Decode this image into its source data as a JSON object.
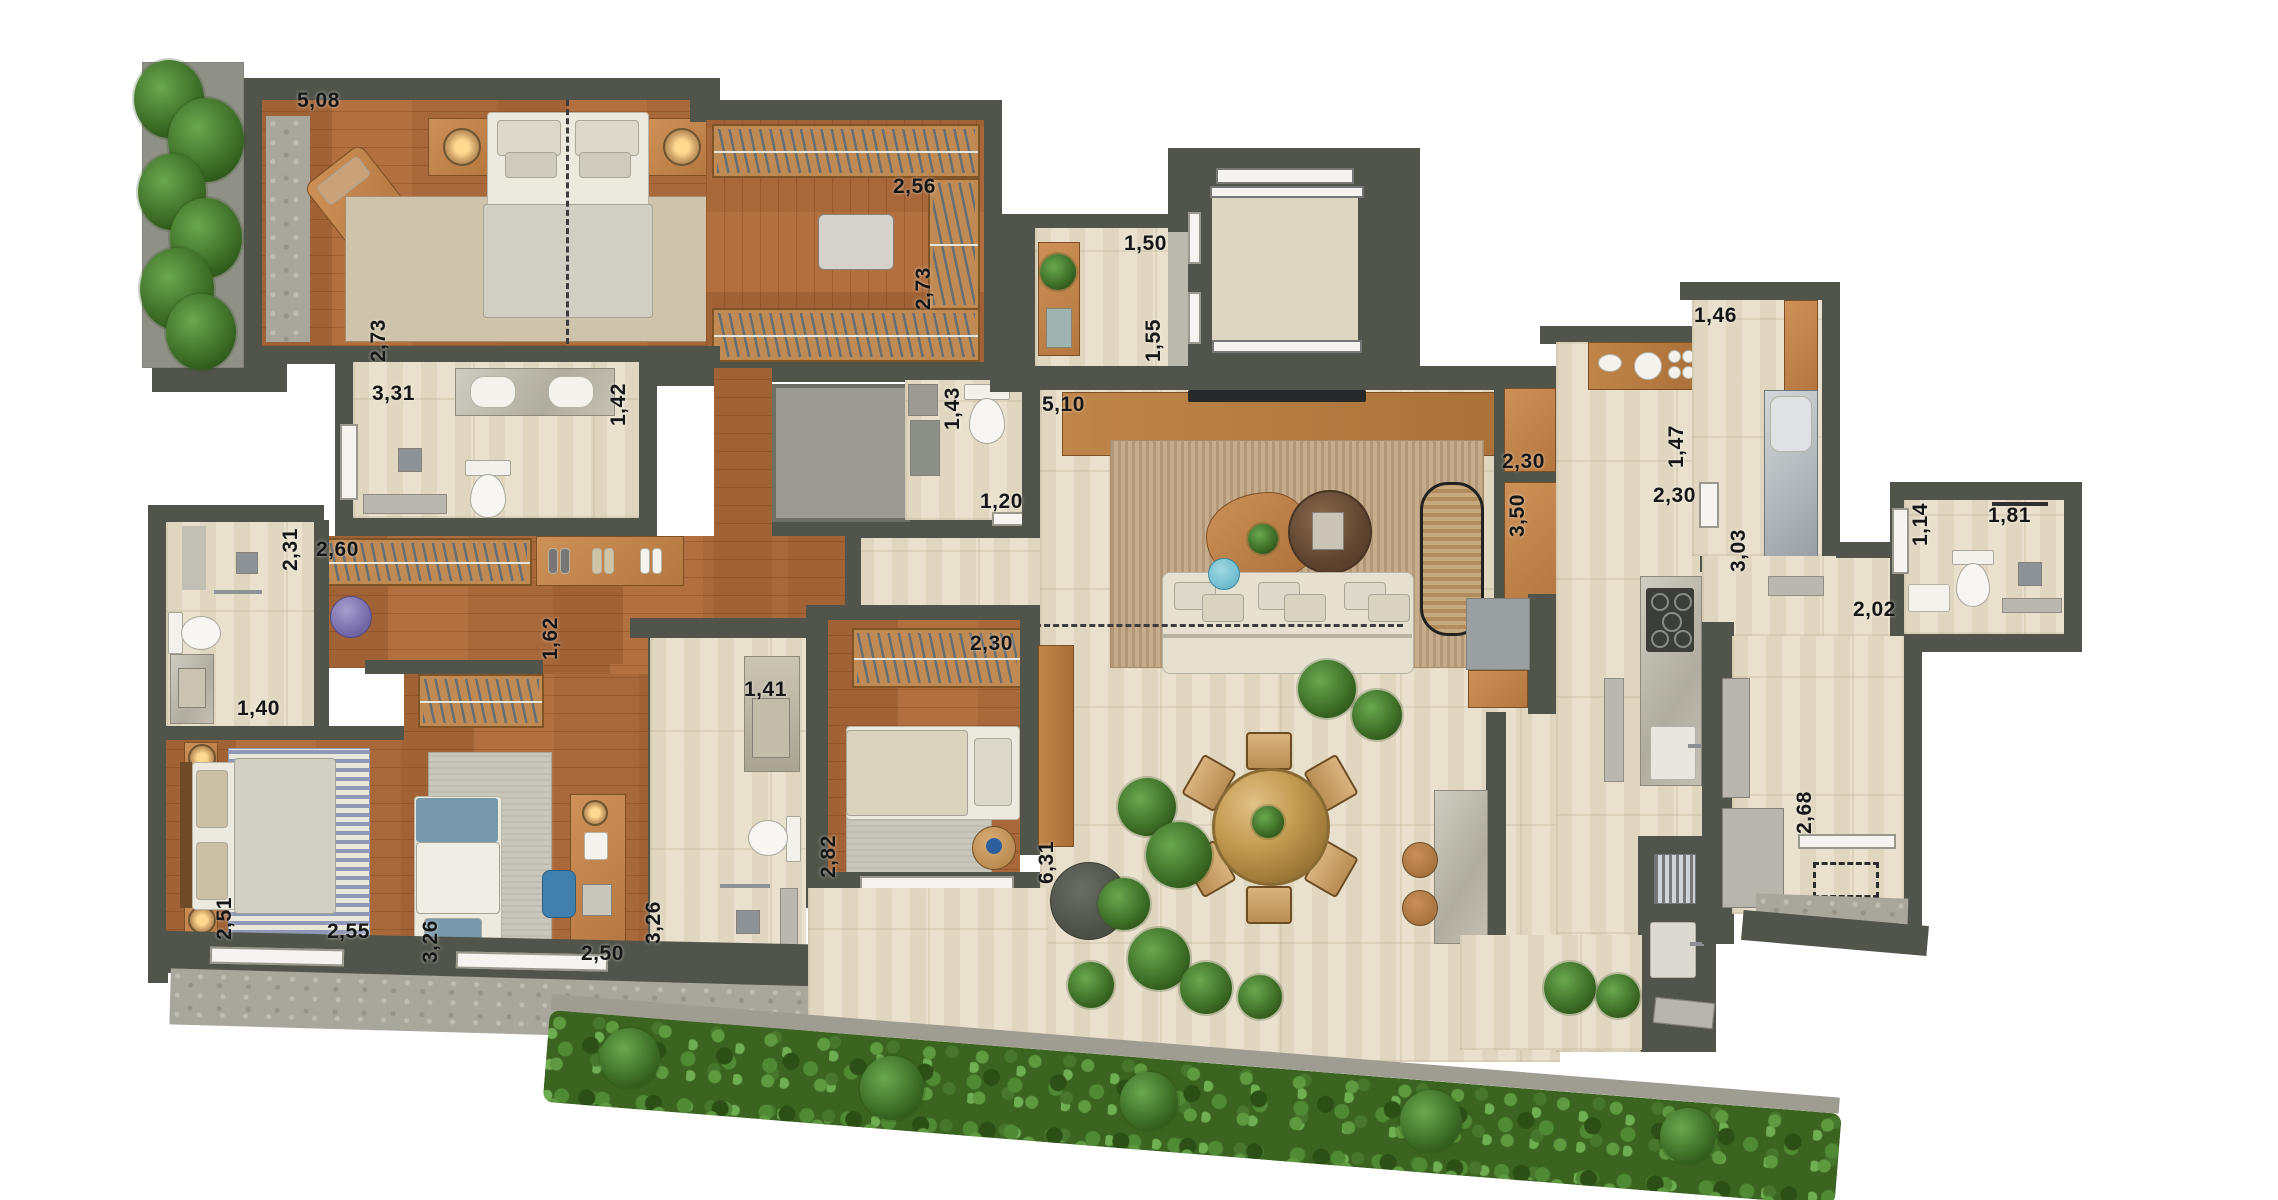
{
  "plan": {
    "title_semantic": "apartment-floor-plan-render",
    "canvas": {
      "width": 2278,
      "height": 1200,
      "background": "#ffffff"
    },
    "palette": {
      "wall": "#51544a",
      "travertine_floor": "#e8e0cc",
      "wood_floor": "#b06f40",
      "furniture_wood": "#c08a55",
      "greenery": "#3f7029",
      "steel": "#9aa0a4",
      "accent_blue": "#6fb7cf",
      "accent_purple": "#8279b2",
      "label_color": "#161616"
    },
    "dimension_labels": [
      {
        "id": "master-bedroom-width",
        "value": "5,08",
        "x": 297,
        "y": 90,
        "orientation": "horizontal"
      },
      {
        "id": "master-bedroom-depth",
        "value": "2,73",
        "x": 368,
        "y": 362,
        "orientation": "vertical"
      },
      {
        "id": "closet-width",
        "value": "2,56",
        "x": 893,
        "y": 176,
        "orientation": "horizontal"
      },
      {
        "id": "closet-depth",
        "value": "2,73",
        "x": 913,
        "y": 310,
        "orientation": "vertical"
      },
      {
        "id": "master-bath-width",
        "value": "3,31",
        "x": 372,
        "y": 383,
        "orientation": "horizontal"
      },
      {
        "id": "master-bath-depth",
        "value": "1,42",
        "x": 608,
        "y": 426,
        "orientation": "vertical"
      },
      {
        "id": "wc-depth",
        "value": "1,43",
        "x": 942,
        "y": 430,
        "orientation": "vertical"
      },
      {
        "id": "wc-width",
        "value": "1,20",
        "x": 980,
        "y": 491,
        "orientation": "horizontal"
      },
      {
        "id": "entry-width",
        "value": "1,50",
        "x": 1124,
        "y": 233,
        "orientation": "horizontal"
      },
      {
        "id": "entry-depth",
        "value": "1,55",
        "x": 1143,
        "y": 362,
        "orientation": "vertical"
      },
      {
        "id": "living-width",
        "value": "5,10",
        "x": 1042,
        "y": 394,
        "orientation": "horizontal"
      },
      {
        "id": "niche-upper",
        "value": "2,30",
        "x": 1502,
        "y": 451,
        "orientation": "horizontal"
      },
      {
        "id": "niche-lower",
        "value": "3,50",
        "x": 1507,
        "y": 537,
        "orientation": "vertical"
      },
      {
        "id": "laundry-width",
        "value": "1,46",
        "x": 1694,
        "y": 305,
        "orientation": "horizontal"
      },
      {
        "id": "kitchen-pass-depth",
        "value": "1,47",
        "x": 1666,
        "y": 468,
        "orientation": "vertical"
      },
      {
        "id": "kitchen-width",
        "value": "2,30",
        "x": 1653,
        "y": 485,
        "orientation": "horizontal"
      },
      {
        "id": "kitchen-depth",
        "value": "3,03",
        "x": 1728,
        "y": 572,
        "orientation": "vertical"
      },
      {
        "id": "service-hall-width",
        "value": "2,02",
        "x": 1853,
        "y": 599,
        "orientation": "horizontal"
      },
      {
        "id": "bath2-depth",
        "value": "1,14",
        "x": 1910,
        "y": 546,
        "orientation": "vertical"
      },
      {
        "id": "bath2-width",
        "value": "1,81",
        "x": 1988,
        "y": 505,
        "orientation": "horizontal"
      },
      {
        "id": "service-room-depth",
        "value": "2,68",
        "x": 1794,
        "y": 834,
        "orientation": "vertical"
      },
      {
        "id": "hall-closet-width",
        "value": "2,60",
        "x": 316,
        "y": 539,
        "orientation": "horizontal"
      },
      {
        "id": "hall-corridor-width",
        "value": "1,62",
        "x": 540,
        "y": 660,
        "orientation": "vertical"
      },
      {
        "id": "bath3-depth",
        "value": "2,31",
        "x": 280,
        "y": 571,
        "orientation": "vertical"
      },
      {
        "id": "bath3-width",
        "value": "1,40",
        "x": 237,
        "y": 698,
        "orientation": "horizontal"
      },
      {
        "id": "bedroom1-depth",
        "value": "2,51",
        "x": 214,
        "y": 940,
        "orientation": "vertical"
      },
      {
        "id": "bedroom1-width",
        "value": "2,55",
        "x": 327,
        "y": 921,
        "orientation": "horizontal"
      },
      {
        "id": "bedroom2-depth",
        "value": "3,26",
        "x": 420,
        "y": 963,
        "orientation": "vertical"
      },
      {
        "id": "bedroom2-width",
        "value": "2,50",
        "x": 581,
        "y": 943,
        "orientation": "horizontal"
      },
      {
        "id": "bath4-width",
        "value": "1,41",
        "x": 744,
        "y": 679,
        "orientation": "horizontal"
      },
      {
        "id": "bath4-depth",
        "value": "3,26",
        "x": 643,
        "y": 944,
        "orientation": "vertical"
      },
      {
        "id": "bedroom3-depth",
        "value": "2,82",
        "x": 818,
        "y": 878,
        "orientation": "vertical"
      },
      {
        "id": "bedroom3-closet",
        "value": "2,30",
        "x": 970,
        "y": 633,
        "orientation": "horizontal"
      },
      {
        "id": "terrace-depth",
        "value": "6,31",
        "x": 1036,
        "y": 884,
        "orientation": "vertical"
      }
    ],
    "rooms": [
      {
        "name": "master-bedroom",
        "furniture": [
          "double-bed",
          "nightstands",
          "lamps",
          "lounge-chair",
          "rug",
          "vertical-garden"
        ]
      },
      {
        "name": "walk-in-closet",
        "furniture": [
          "hanger-racks",
          "ottoman"
        ]
      },
      {
        "name": "master-bathroom",
        "furniture": [
          "vanity",
          "toilet",
          "shower"
        ]
      },
      {
        "name": "shower-box-room",
        "furniture": [
          "enclosed-shower"
        ]
      },
      {
        "name": "powder-room",
        "furniture": [
          "toilet",
          "washbasin-niche"
        ]
      },
      {
        "name": "entry-hall",
        "furniture": [
          "console",
          "plant",
          "intercom"
        ]
      },
      {
        "name": "elevator",
        "furniture": [
          "elevator-car"
        ]
      },
      {
        "name": "living-dining",
        "furniture": [
          "tv-console",
          "tv",
          "sofa",
          "rug",
          "coffee-tables",
          "chaise",
          "dining-table",
          "six-chairs",
          "island",
          "stools"
        ]
      },
      {
        "name": "kitchen",
        "furniture": [
          "cooktop-counter",
          "sink",
          "fridge-recess"
        ]
      },
      {
        "name": "laundry",
        "furniture": [
          "steel-sink-counter",
          "shelf"
        ]
      },
      {
        "name": "service-bathroom",
        "furniture": [
          "toilet",
          "sink",
          "shower"
        ]
      },
      {
        "name": "service-room",
        "furniture": [
          "equipment-panels",
          "dashed-reservation"
        ]
      },
      {
        "name": "hall",
        "furniture": [
          "coat-racks",
          "shoe-shelf",
          "pouf"
        ]
      },
      {
        "name": "bathroom-suite2",
        "furniture": [
          "shower",
          "toilet",
          "vanity"
        ]
      },
      {
        "name": "bedroom1",
        "furniture": [
          "double-bed",
          "striped-rug",
          "nightstands"
        ]
      },
      {
        "name": "bedroom2",
        "furniture": [
          "single-bed",
          "desk",
          "chair",
          "rug",
          "closet-rack"
        ]
      },
      {
        "name": "bathroom-3",
        "furniture": [
          "vanity",
          "toilet",
          "shower"
        ]
      },
      {
        "name": "bedroom3",
        "furniture": [
          "single-bed",
          "rug",
          "side-table",
          "closet-rack"
        ]
      },
      {
        "name": "terrace",
        "furniture": [
          "bench",
          "fire-table",
          "planting",
          "hedge",
          "gourmet-grill",
          "outdoor-sink"
        ]
      }
    ]
  }
}
